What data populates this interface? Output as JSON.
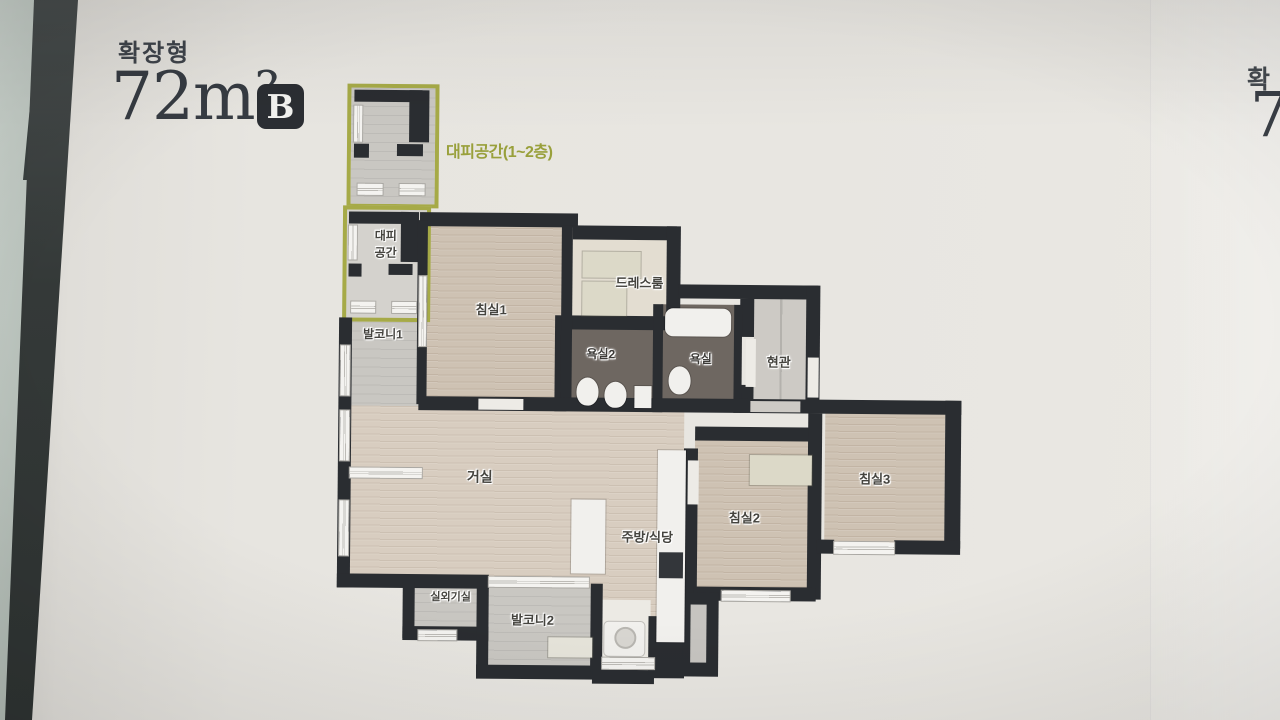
{
  "header": {
    "plan_type": "확장형",
    "area": "72m²",
    "unit_badge": "B",
    "inset_caption": "대피공간(1~2층)"
  },
  "rooms": {
    "evac_line1": "대피",
    "evac_line2": "공간",
    "balcony1": "발코니1",
    "bedroom1": "침실1",
    "dressroom": "드레스룸",
    "bathroom2": "욕실2",
    "bathroom1": "욕실",
    "entrance": "현관",
    "living": "거실",
    "kitchen_dining": "주방/식당",
    "bedroom2": "침실2",
    "bedroom3": "침실3",
    "outdoor_unit": "실외기실",
    "balcony2": "발코니2"
  },
  "adjacent_page": {
    "plan_type_partial": "확",
    "area_partial": "7"
  },
  "colors": {
    "accent_olive": "#9aa03b",
    "wall": "#2a2d31",
    "badge_bg": "#2b2e33",
    "wood_floor": "#cec2b3",
    "bath_floor": "#6e6761",
    "board_bg": "#e8e6e1"
  }
}
